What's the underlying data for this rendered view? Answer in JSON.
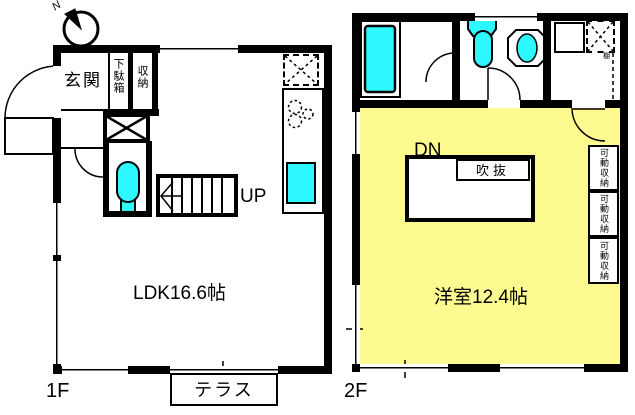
{
  "compass": {
    "north_label": "N"
  },
  "floor1": {
    "floor_label": "1F",
    "entrance_label": "玄関",
    "shoe_cabinet_label": "下駄箱",
    "storage_label": "収納",
    "ldk_label": "LDK16.6帖",
    "stairs_up_label": "UP",
    "terrace_label": "テラス"
  },
  "floor2": {
    "floor_label": "2F",
    "stairs_down_label": "DN",
    "void_label": "吹抜",
    "room_label": "洋室12.4帖",
    "shelf_label": "棚",
    "movable_storage": [
      {
        "label": "可動収納"
      },
      {
        "label": "可動収納"
      },
      {
        "label": "可動収納"
      }
    ]
  },
  "colors": {
    "fixture_cyan": "#2EF8FF",
    "room_yellow": "#FDFB8F",
    "line_black": "#000000"
  }
}
